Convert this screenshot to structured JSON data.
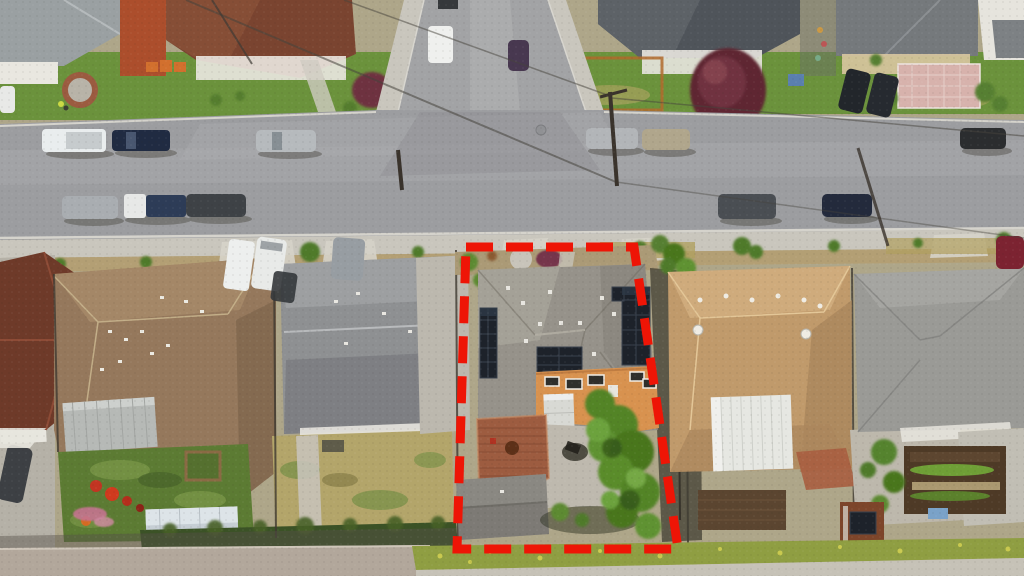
{
  "scene": {
    "type": "aerial-photograph",
    "setting": "suburban residential block, top-down drone view",
    "annotation": "red dashed outline marking one property's lot lines",
    "time_of_day": "daytime",
    "image_width": 1024,
    "image_height": 576
  },
  "boundary": {
    "shape": "quadrilateral",
    "stroke_style": "dashed",
    "color": "#ee1506",
    "points": "466,247 634,247 678,549 457,549",
    "dash": "27 13",
    "thickness": 9
  },
  "palette": {
    "road": "#9c9da0",
    "side_road": "#a2a3a5",
    "sidewalk": "#c9c6bd",
    "parkway_dirt": "#b39f74",
    "lawn_green": "#6b923c",
    "backyard_lawn": "#5c7b33",
    "dry_grass": "#b3a56a",
    "bottom_grass_strip": "#8f9e42",
    "subject_roof_gray": "#96928a",
    "subject_house_orange": "#d8924f",
    "solar_panel_dark": "#1d222a",
    "deck_redwood": "#9d5c40",
    "left_neighbor_roof_gray": "#8e9092",
    "tan_hip_roof": "#95785c",
    "auburn_roof": "#6e3a29",
    "right_neighbor_roof_tan": "#c09a6b",
    "far_right_roof_gray": "#9a9a96",
    "top_center_roof_charcoal": "#4f545a",
    "top_left_brown_roof": "#7a4430",
    "top_right_roof_gray": "#75797c",
    "tree_green": "#538427",
    "tree_maroon": "#5e2633",
    "hedge_dark_green": "#3b5226",
    "shed_pale_blue": "#c6ced4",
    "patio_cover_white": "#e6e7e2",
    "pavement_bottom": "#b2a79b"
  },
  "subject_property": {
    "features": [
      "gray composition-shingle cross-hip roof",
      "three rooftop solar arrays",
      "orange two-story rear elevation with white-trimmed windows",
      "redwood rear deck",
      "detached rear garage",
      "large green tree along east side",
      "concrete rear patio and driveway"
    ]
  },
  "neighborhood": {
    "north_of_street": [
      "brown-roof house with front lawn and circular brick planter",
      "charcoal-roof house with deep-maroon ornamental tree",
      "gray-roof house with pink paver courtyard and two dark SUVs in driveway"
    ],
    "south_row": [
      "auburn-roof house (far west, partial)",
      "tan hip-roof house with rear lawn, garden box, play equipment and pale-blue shed",
      "gray gable-roof house with dry rear lawn",
      "subject property outlined in red",
      "tan-roof house with white corrugated patio cover and brown shed",
      "gray-roof house with vegetable garden beds (far east)"
    ],
    "streets": "one horizontal street across the upper third meeting a side street at a T-intersection",
    "utilities": "overhead power lines and wooden poles crossing the street"
  },
  "vehicles": [
    {
      "type": "work truck",
      "color": "white",
      "location": "north curb west"
    },
    {
      "type": "pickup",
      "color": "dark navy",
      "location": "north curb west"
    },
    {
      "type": "suv",
      "color": "silver",
      "location": "north curb center-west"
    },
    {
      "type": "sedan",
      "color": "silver",
      "location": "north curb center-east"
    },
    {
      "type": "sedan",
      "color": "tan",
      "location": "north curb center-east"
    },
    {
      "type": "sedan",
      "color": "black",
      "location": "north curb far east"
    },
    {
      "type": "sedan",
      "color": "silver",
      "location": "south curb west"
    },
    {
      "type": "truck",
      "color": "white cab navy bed",
      "location": "south curb west"
    },
    {
      "type": "suv",
      "color": "dark gray",
      "location": "south curb west"
    },
    {
      "type": "suv",
      "color": "dark gray",
      "location": "south curb east"
    },
    {
      "type": "sedan",
      "color": "dark navy",
      "location": "south curb east"
    },
    {
      "type": "car",
      "color": "maroon",
      "location": "south curb far east"
    },
    {
      "type": "van",
      "color": "white",
      "location": "driveway south-west"
    },
    {
      "type": "suv",
      "color": "white",
      "location": "driveway south-west"
    },
    {
      "type": "van",
      "color": "gray",
      "location": "driveway south-west"
    },
    {
      "type": "suv",
      "color": "black",
      "location": "driveway north-east"
    },
    {
      "type": "suv",
      "color": "black",
      "location": "driveway north-east"
    },
    {
      "type": "van",
      "color": "white",
      "location": "side street"
    },
    {
      "type": "car",
      "color": "dark plum",
      "location": "side street"
    },
    {
      "type": "car",
      "color": "dark gray",
      "location": "far west driveway"
    }
  ]
}
